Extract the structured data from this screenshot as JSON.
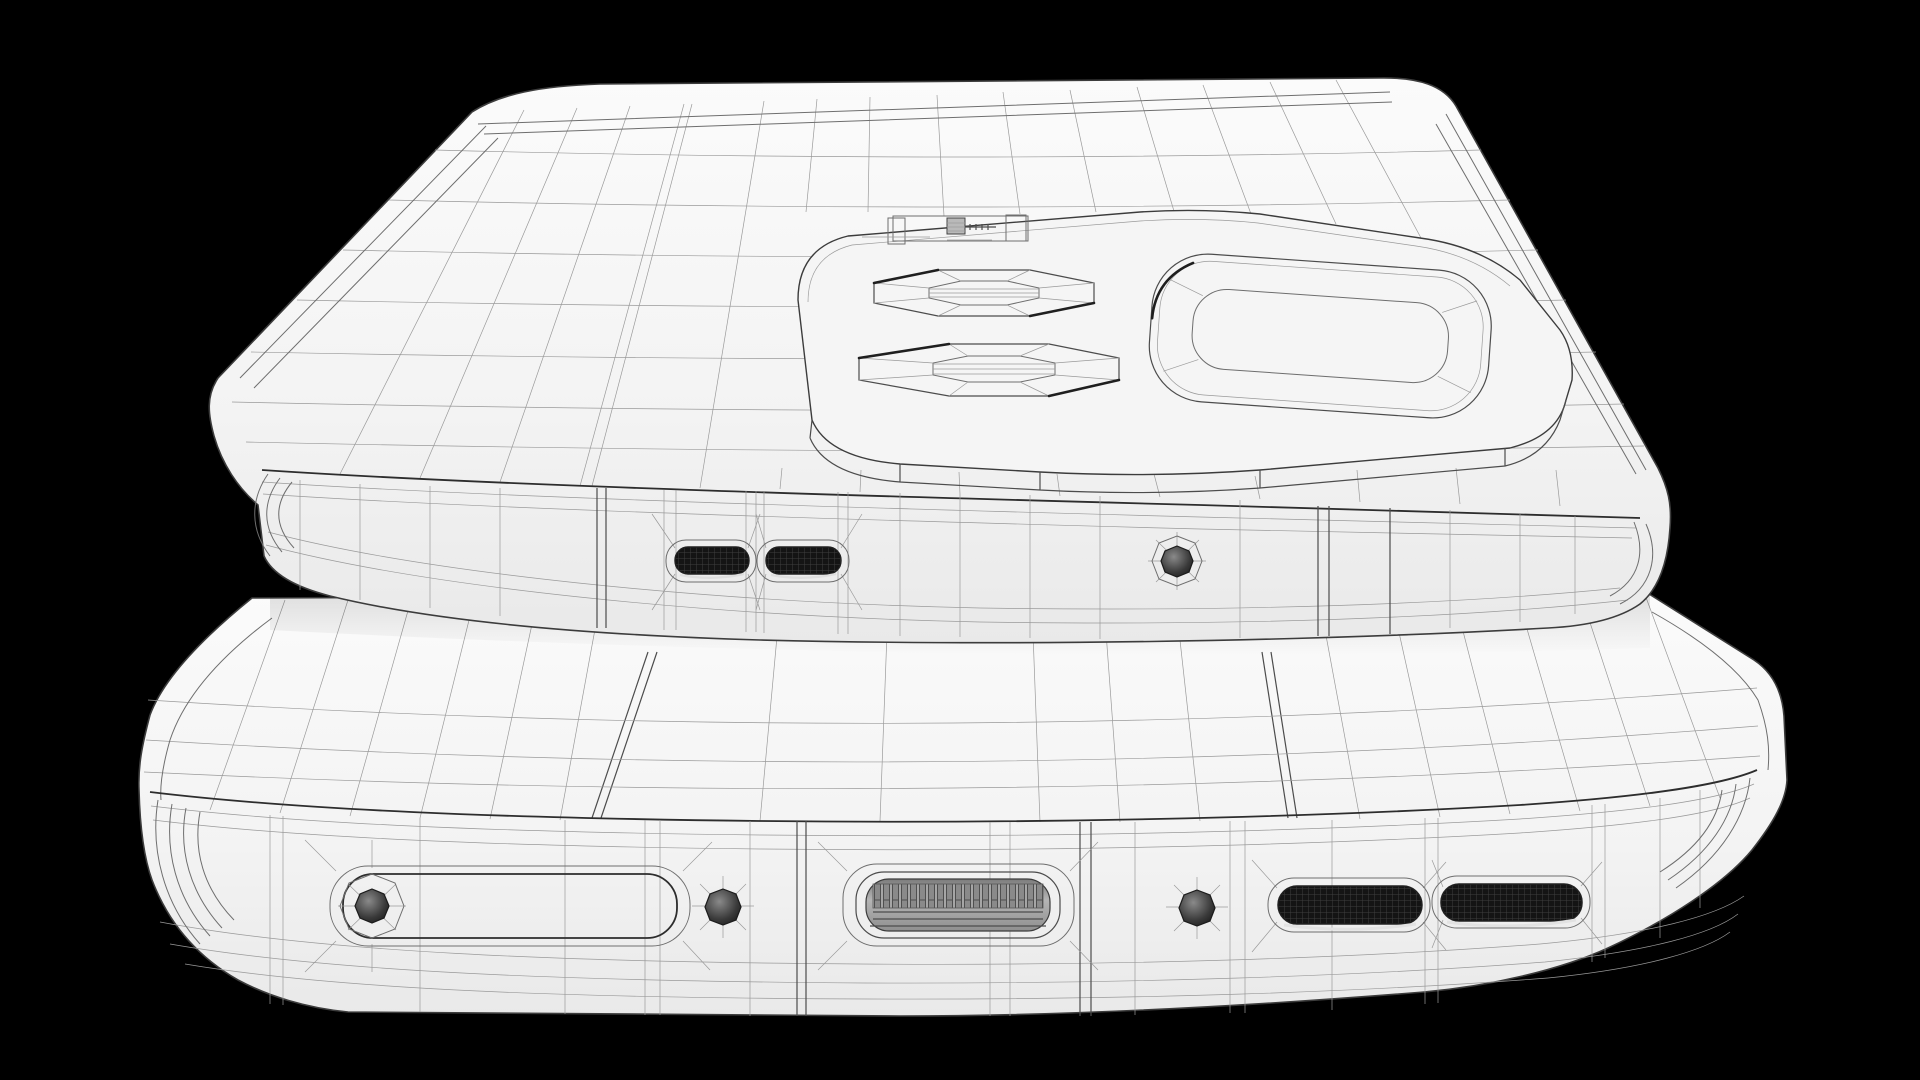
{
  "scene": {
    "title": "Monochrome 3D wireframe render of two stacked smartphones on black background",
    "background_color": "#000000",
    "body_color": "#f4f4f4",
    "wire_color": "#6e6e6e",
    "accent_wire_color": "#242424",
    "fine_wire_color": "#9a9a9a",
    "hole_dark_color": "#111111",
    "port_metal_color": "#b2b2b2"
  },
  "top_phone": {
    "name": "smartphone back, top of stack",
    "camera_module": {
      "type": "raised rounded camera island",
      "lens_count": 2,
      "extra_ring": "large rounded-square sensor ring",
      "flash": "flash and sensor strip"
    },
    "edge_features": [
      "speaker-slot",
      "speaker-slot",
      "microphone-hole",
      "antenna-band-seam",
      "antenna-band-seam"
    ]
  },
  "bottom_phone": {
    "name": "smartphone bottom edge, base of stack",
    "edge_features": [
      "sim-tray",
      "sim-eject-hole",
      "microphone-hole",
      "usb-c-port",
      "microphone-hole",
      "speaker-grille",
      "speaker-grille",
      "antenna-band-seam"
    ]
  }
}
